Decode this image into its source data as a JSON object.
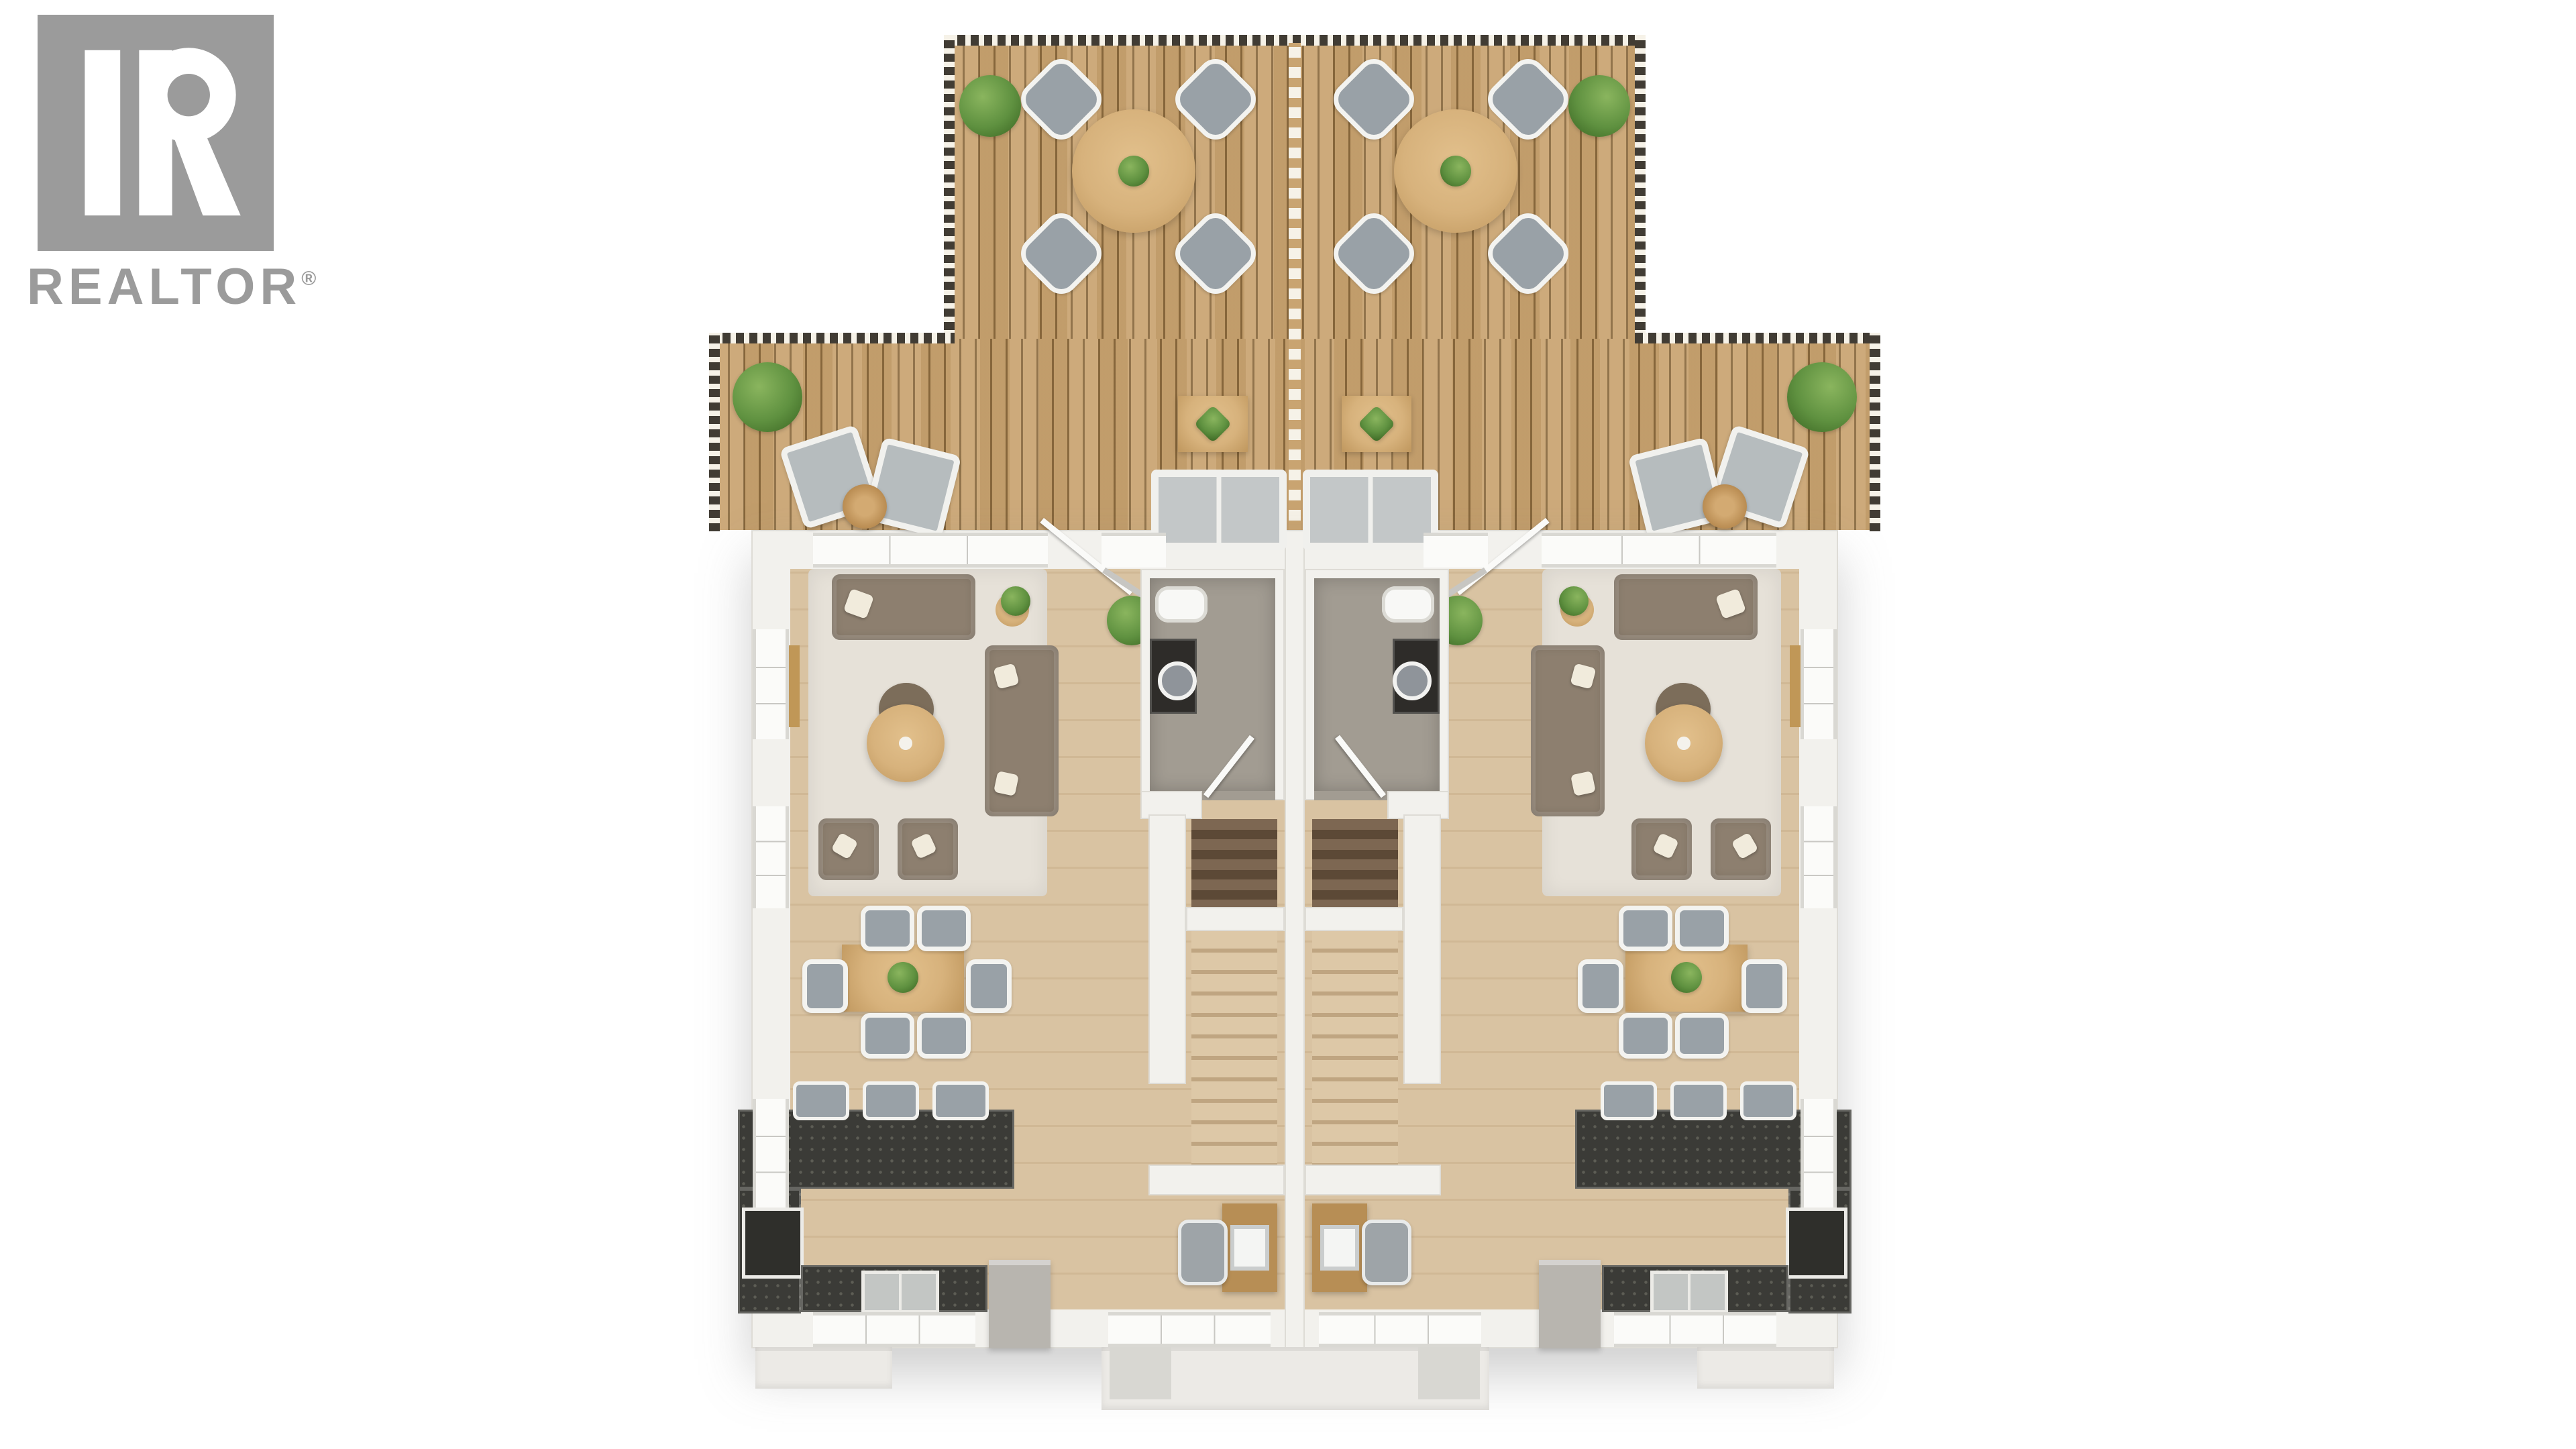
{
  "brand": {
    "name": "REALTOR",
    "reg": "®"
  },
  "plan": {
    "type": "floor-plan",
    "style": "top-down 3D real-estate render, mirrored duplex (two identical units)",
    "units": [
      "left-unit",
      "right-unit"
    ],
    "areas": [
      "roof-deck",
      "living-room",
      "bathroom",
      "staircase",
      "dining-area",
      "kitchen",
      "desk-nook",
      "entry-porch"
    ],
    "deck_furniture": [
      "round table with 4 chairs (per unit)",
      "2 lounge chairs with wicker side table (per unit)",
      "coffee table with plant (per unit)",
      "outdoor sofa (per unit)",
      "corner planters"
    ],
    "interior_furniture": [
      "3-piece brown lounge suite with round coffee table",
      "6-seat dining table with plant centerpiece",
      "U-shaped dark stone kitchen counter with 3 bar stools",
      "stove",
      "fridge",
      "toilet",
      "dark vanity with round sink",
      "desk with office chair and laptop"
    ]
  },
  "colors": {
    "page-bg": "#ffffff",
    "logo": "#9b9b9b",
    "deck-wood": "#c9a471",
    "deck-groove": "#8a6a3e",
    "rail-dark": "#413c34",
    "rail-light": "#f6f2e8",
    "wall": "#f2f1ed",
    "wall-edge": "#dedcd6",
    "floor": "#d9c3a2",
    "rug": "#e6e1d8",
    "sofa": "#8d7f6f",
    "pillow": "#f1ebdc",
    "wood": "#d7b27c",
    "chair": "#99a1a7",
    "frame": "#f3f3f0",
    "counter": "#3b3b37",
    "speck": "#5d5d55",
    "bathfloor": "#a29c92",
    "vanity": "#2e2c29",
    "stairdk1": "#7d6752",
    "stairdk2": "#5c4936",
    "stairlt1": "#ddc8a7",
    "stairlt2": "#bfa581",
    "green1": "#5f9140",
    "green2": "#3f6b26",
    "appliance": "#b8b5af",
    "porch": "#eceae6",
    "desk-wood": "#b78e55"
  }
}
